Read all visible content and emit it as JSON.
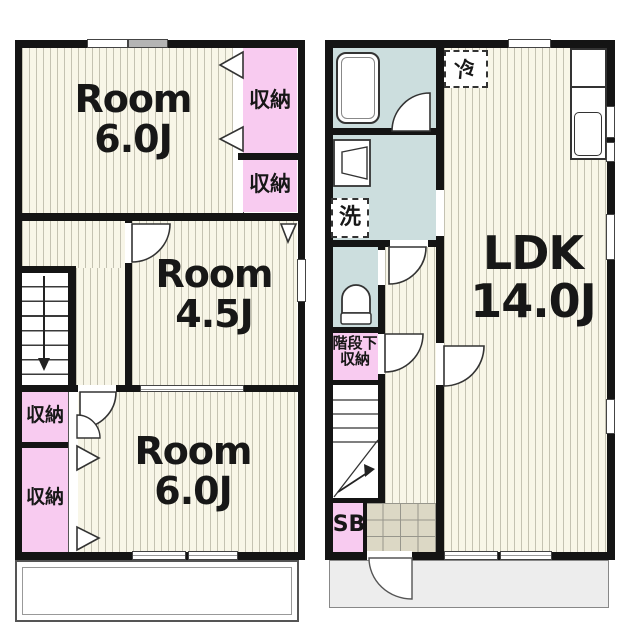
{
  "floor2": {
    "room_top": {
      "line1": "Room",
      "line2": "6.0J"
    },
    "room_mid": {
      "line1": "Room",
      "line2": "4.5J"
    },
    "room_bottom": {
      "line1": "Room",
      "line2": "6.0J"
    },
    "closet_top_upper": "収納",
    "closet_top_lower": "収納",
    "closet_bottom_upper": "収納",
    "closet_bottom_lower": "収納"
  },
  "floor1": {
    "ldk": {
      "line1": "LDK",
      "line2": "14.0J"
    },
    "laundry_symbol": "洗",
    "fridge_symbol": "冷",
    "understairs_storage": {
      "line1": "階段下",
      "line2": "収納"
    },
    "shoebox": "SB"
  },
  "colors": {
    "wall": "#141414",
    "tatami_floor": "#f8f6e8",
    "closet_pink": "#f8cbf0",
    "wet_room_blue": "#ccdede",
    "entrance_tile": "#dcd8c5",
    "porch_gray": "#ededed"
  }
}
